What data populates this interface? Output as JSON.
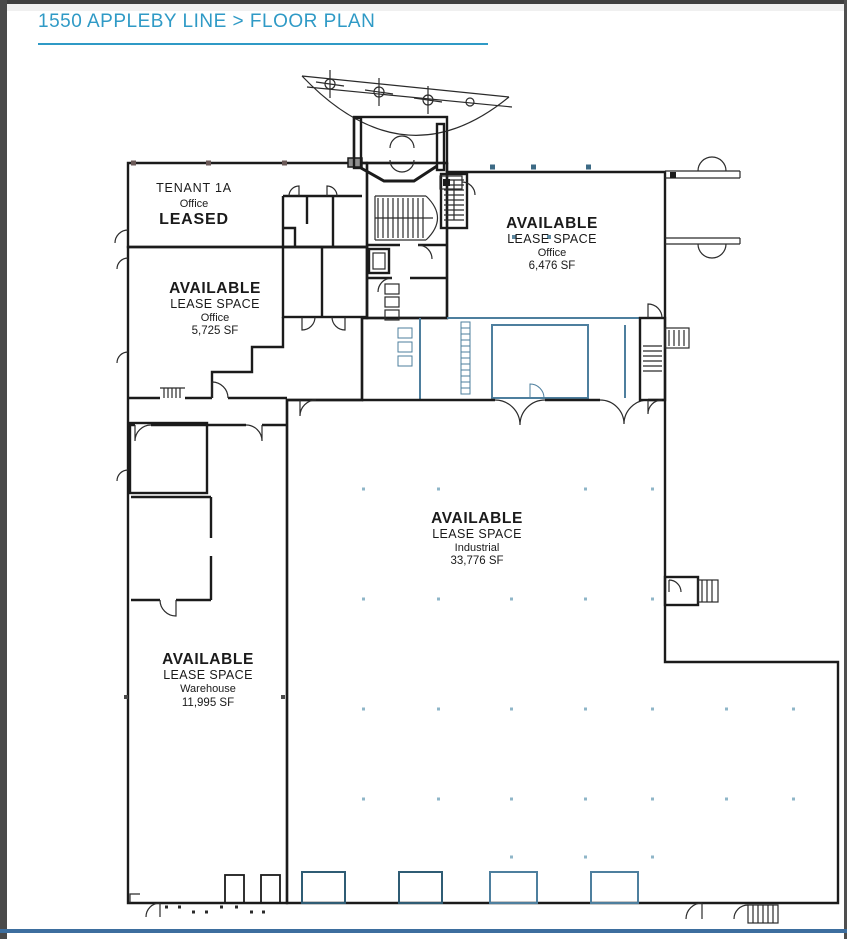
{
  "header": {
    "title": "1550 APPLEBY LINE > FLOOR PLAN"
  },
  "theme": {
    "accent": "#2F9AC6",
    "footer_rule": "#3D6E9E",
    "window_frame": "#4A4A4A",
    "wall": "#1B1B1B",
    "leased_fill": "#F1B9B6",
    "gray_fill": "#B3B3B3",
    "blue_fill": "#A7D2E8",
    "blue_wall": "#4E7F9E"
  },
  "spaces": {
    "tenant_1a": {
      "tenant": "TENANT 1A",
      "use": "Office",
      "status": "LEASED"
    },
    "office_5725": {
      "status": "AVAILABLE",
      "label": "LEASE SPACE",
      "use": "Office",
      "area": "5,725 SF"
    },
    "office_6476": {
      "status": "AVAILABLE",
      "label": "LEASE SPACE",
      "use": "Office",
      "area": "6,476 SF"
    },
    "industrial_33776": {
      "status": "AVAILABLE",
      "label": "LEASE SPACE",
      "use": "Industrial",
      "area": "33,776 SF"
    },
    "warehouse_11995": {
      "status": "AVAILABLE",
      "label": "LEASE SPACE",
      "use": "Warehouse",
      "area": "11,995 SF"
    }
  }
}
